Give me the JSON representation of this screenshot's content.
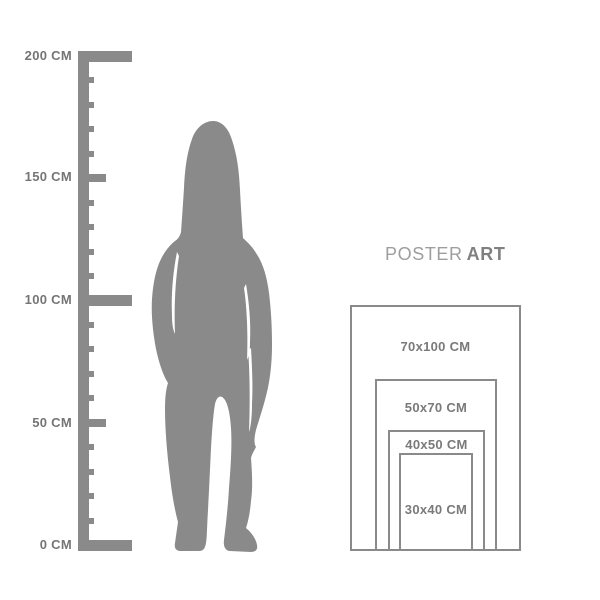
{
  "background": "#ffffff",
  "colors": {
    "figure": "#8a8a8a",
    "ruler": "#8a8a8a",
    "ruler_label": "#757575",
    "poster_border": "#8a8a8a",
    "poster_label": "#7a7a7a",
    "title_regular": "#9e9e9e",
    "title_bold": "#808080"
  },
  "ruler": {
    "unit": "CM",
    "min_cm": 0,
    "max_cm": 200,
    "small_step_cm": 10,
    "medium_step_cm": 50,
    "major_step_cm": 100,
    "color": "#8a8a8a",
    "labels": [
      {
        "text": "200 CM",
        "cm": 200
      },
      {
        "text": "150 CM",
        "cm": 150
      },
      {
        "text": "100 CM",
        "cm": 100
      },
      {
        "text": "50 CM",
        "cm": 50
      },
      {
        "text": "0 CM",
        "cm": 0
      }
    ]
  },
  "figure": {
    "description": "standing woman silhouette, long hair, hands at hips"
  },
  "title": {
    "regular": "POSTER",
    "bold": "ART"
  },
  "poster_sizes": {
    "items": [
      {
        "label": "70x100 CM",
        "width_cm": 70,
        "height_cm": 100
      },
      {
        "label": "50x70 CM",
        "width_cm": 50,
        "height_cm": 70
      },
      {
        "label": "40x50 CM",
        "width_cm": 40,
        "height_cm": 50
      },
      {
        "label": "30x40 CM",
        "width_cm": 30,
        "height_cm": 40
      }
    ]
  }
}
